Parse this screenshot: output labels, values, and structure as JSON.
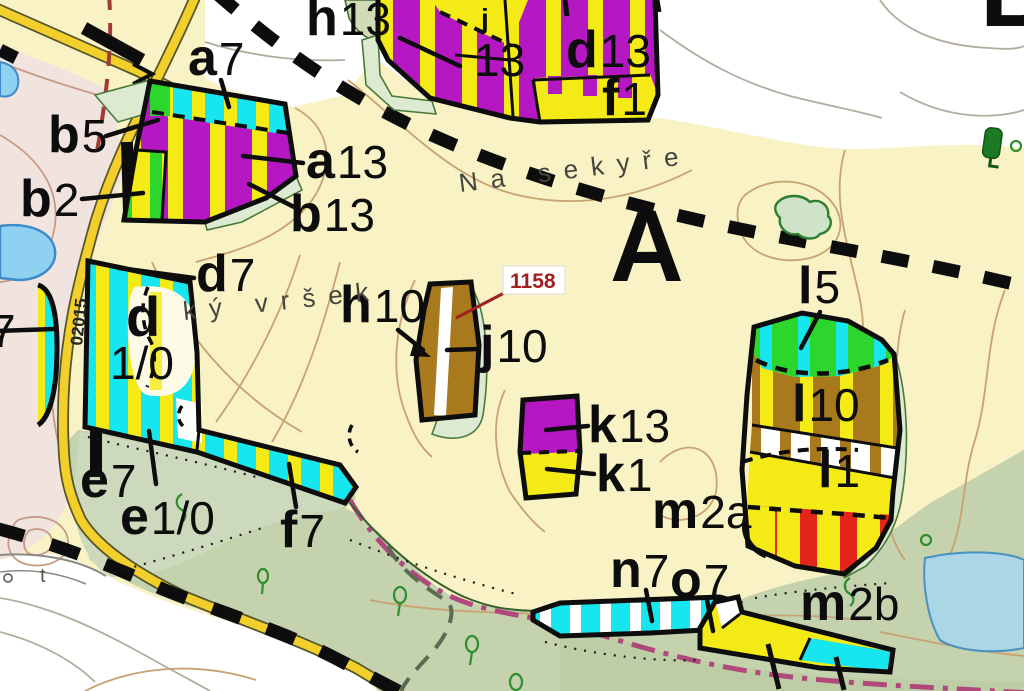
{
  "map": {
    "region_labels": {
      "primary": "A",
      "partial_top_right": "B"
    },
    "place_names": {
      "na_sekyre": "Na sekyře",
      "ky_vrsek": "ký vršek"
    },
    "road_number": "02015",
    "parcel_reference": "1158",
    "top_edge_glyph": "j",
    "ground_glyph_t": "t",
    "stand_labels": {
      "a7": {
        "letter": "a",
        "number": "7"
      },
      "b5": {
        "letter": "b",
        "number": "5"
      },
      "b2": {
        "letter": "b",
        "number": "2"
      },
      "a13": {
        "letter": "a",
        "number": "13"
      },
      "b13": {
        "letter": "b",
        "number": "13"
      },
      "h13": {
        "letter": "h",
        "number": "13"
      },
      "top13": {
        "letter": "",
        "number": "13"
      },
      "d13": {
        "letter": "d",
        "number": "13"
      },
      "f1": {
        "letter": "f",
        "number": "1"
      },
      "d7": {
        "letter": "d",
        "number": "7"
      },
      "d_big": {
        "letter": "d",
        "number": ""
      },
      "d_10": {
        "letter": "",
        "number": "1/0"
      },
      "left7": {
        "letter": "",
        "number": "7"
      },
      "h10": {
        "letter": "h",
        "number": "10"
      },
      "j10": {
        "letter": "j",
        "number": "10"
      },
      "k13": {
        "letter": "k",
        "number": "13"
      },
      "k1": {
        "letter": "k",
        "number": "1"
      },
      "l5": {
        "letter": "l",
        "number": "5"
      },
      "l10": {
        "letter": "l",
        "number": "10"
      },
      "l1": {
        "letter": "l",
        "number": "1"
      },
      "m2a": {
        "letter": "m",
        "number": "2a"
      },
      "m2b": {
        "letter": "m",
        "number": "2b"
      },
      "n7": {
        "letter": "n",
        "number": "7"
      },
      "o7": {
        "letter": "o",
        "number": "7"
      },
      "e7": {
        "letter": "e",
        "number": "7"
      },
      "e10": {
        "letter": "e",
        "number": "1/0"
      },
      "f7": {
        "letter": "f",
        "number": "7"
      }
    },
    "colors": {
      "background_parchment": "#f8f2c4",
      "white_area": "#ffffff",
      "pink_area": "#f1e4df",
      "forest_green_area": "#c4d2ae",
      "stand_purple": "#b517c2",
      "stand_yellow": "#f4ea16",
      "stand_cyan": "#17e6ee",
      "stand_green": "#2cd62c",
      "stand_brown": "#a9791d",
      "stand_red": "#e32619",
      "road_yellow": "#f2cf2a",
      "water_blue": "#8ed1f0",
      "boundary_black": "#0d0d0d",
      "boundary_magenta": "#b0487c",
      "boundary_maroon": "#a23b35",
      "contour_tan": "#c8a272",
      "parcel_red": "#a02020"
    }
  }
}
